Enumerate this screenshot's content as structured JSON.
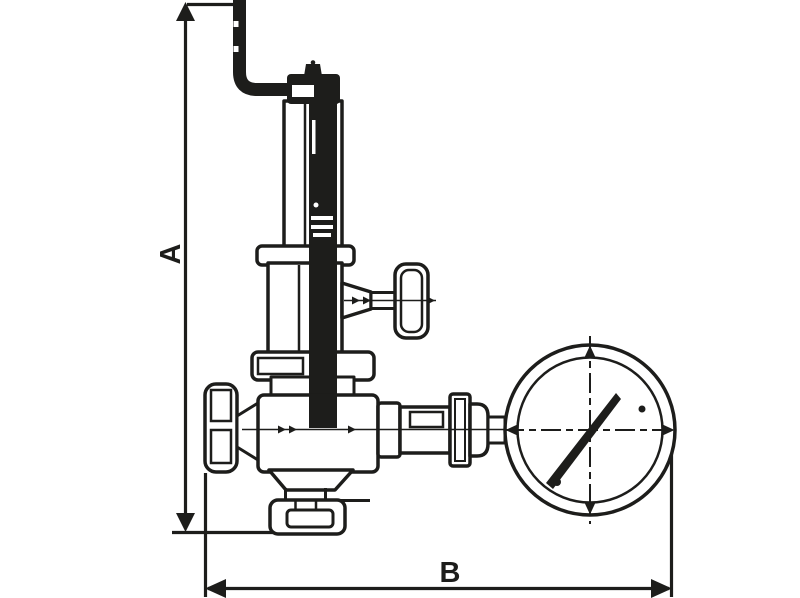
{
  "window": {
    "width": 800,
    "height": 598
  },
  "colors": {
    "background": "#ffffff",
    "ink": "#1d1d1b"
  },
  "drawing": {
    "kind": "technical dimensional line drawing",
    "subject": "pressure reducing / safety valve with discharge pipe and pressure gauge",
    "dimension_labels": {
      "a": "A",
      "b": "B"
    },
    "components": [
      "vertical-dimension-A",
      "horizontal-dimension-B",
      "discharge-pipe",
      "housing-cap",
      "spring-housing",
      "adjusting-stem",
      "upper-flange",
      "lower-chamber",
      "side-branch-tee-handle",
      "bonnet-flange",
      "valve-body",
      "handwheel",
      "outlet-flange",
      "gauge-connection-fittings",
      "pressure-gauge",
      "gauge-needle"
    ]
  }
}
